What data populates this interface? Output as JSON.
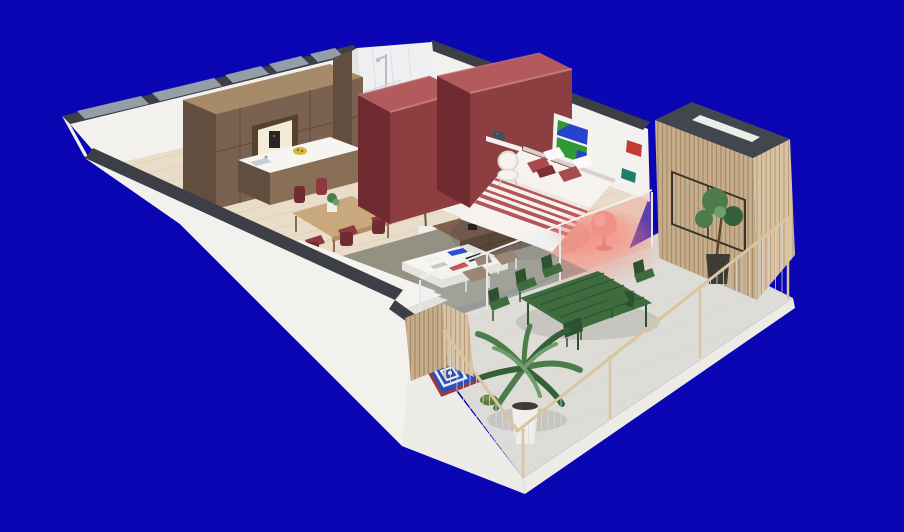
{
  "scene": {
    "description": "Isometric 3D cutaway floor plan render of a one-bedroom apartment with wrap-around terrace, shown on a solid blue background",
    "rooms": [
      {
        "name": "kitchen-dining",
        "objects": [
          "walnut tall cabinets with appliance niche",
          "island with white counter",
          "yellow fruit bowl",
          "oak dining table",
          "burgundy dining chairs",
          "small table plant"
        ]
      },
      {
        "name": "living-room",
        "objects": [
          "white sofa",
          "gray-green rug",
          "white coffee table with red blue and black books",
          "walnut sideboard",
          "table lamp",
          "red framed poster",
          "ficus plant",
          "two lounge chairs"
        ]
      },
      {
        "name": "bathroom",
        "objects": [
          "white tiled walls",
          "chrome shower",
          "glass partition",
          "dark shower tray"
        ]
      },
      {
        "name": "bedroom",
        "objects": [
          "two maroon wardrobe volumes",
          "double bed with red striped throw",
          "red and white pillows",
          "pink glowing round chair",
          "white rattan chair",
          "wall shelf with iron",
          "window style artwork in blue and green",
          "red framed artwork",
          "teal framed artwork"
        ]
      },
      {
        "name": "terrace",
        "objects": [
          "green metal dining table with six green chairs",
          "large palm in white pot",
          "small tree in dark pot",
          "blue and white diamond floor cushion with red trim",
          "green pouf",
          "wood slat privacy screens",
          "cable railing with wooden handrail",
          "slat-clad volume with dark roof and skylight"
        ]
      }
    ]
  },
  "palette": {
    "bg": "#0b06b4",
    "wall_white": "#f3f1ed",
    "wall_dim": "#e7e4df",
    "cap_dark": "#3c4046",
    "window_gray": "#959da7",
    "fascia": "#edebe6",
    "floor_wood": "#e9dcc8",
    "plank_line": "#d9c8b2",
    "concrete": "#dedcd6",
    "concrete_line": "#d2d0c9",
    "walnut_front": "#7b6150",
    "walnut_side": "#624e3e",
    "walnut_top": "#a78a69",
    "walnut_dark": "#55432f",
    "island_wood": "#8a6f57",
    "counter_white": "#f7f5f1",
    "oak": "#c9a87d",
    "oak_side": "#b08f66",
    "chair_red": "#8c3a40",
    "chair_red_dark": "#6f2c31",
    "maroon_top": "#b25a5c",
    "maroon_front": "#8d3e41",
    "maroon_side": "#6f2b2f",
    "maroon_highlight": "#cf8486",
    "bed_white": "#f6f3ef",
    "stripe_red": "#b4555a",
    "pillow_red": "#a84a4e",
    "pillow_dark": "#7e2f33",
    "glow_pink": "#ff6e5a",
    "rug_gray_green": "#8e8c7e",
    "sofa_white": "#f5f3ef",
    "sofa_shadow": "#e4e1da",
    "slat_tan": "#c6ad8c",
    "slat_line": "#a58b68",
    "slat_light": "#d8c4a5",
    "slat_light_line": "#bb9d79",
    "roof_dark": "#42464d",
    "skylight": "#eceeea",
    "green_furniture": "#3e6c3f",
    "green_dark": "#2d5230",
    "leaf_green": "#4d7c4b",
    "leaf_dark": "#35603a",
    "leaf_light": "#6f9e6c",
    "pot_white": "#f0eeea",
    "pot_dark": "#3f3b36",
    "cushion_blue": "#2f4fb5",
    "cushion_white": "#e9edf6",
    "cushion_red": "#9c3a3a",
    "pouf_green": "#5c7a40",
    "rail_wood": "#d9c6a0",
    "cable_gray": "#d5dae0",
    "art_blue": "#2742cb",
    "art_green": "#2f9a33",
    "art_red": "#c23b35",
    "art_teal": "#1f7d6e",
    "frame_white": "#f4f2ee",
    "ink_black": "#26262a",
    "book_blue": "#2a50c8",
    "book_red": "#c4372f",
    "book_mustard": "#c99130",
    "tile_white": "#eef0f2",
    "shower_tray": "#4a4e52",
    "chrome": "#b9bdc2",
    "bowl_yellow": "#d9b838"
  }
}
